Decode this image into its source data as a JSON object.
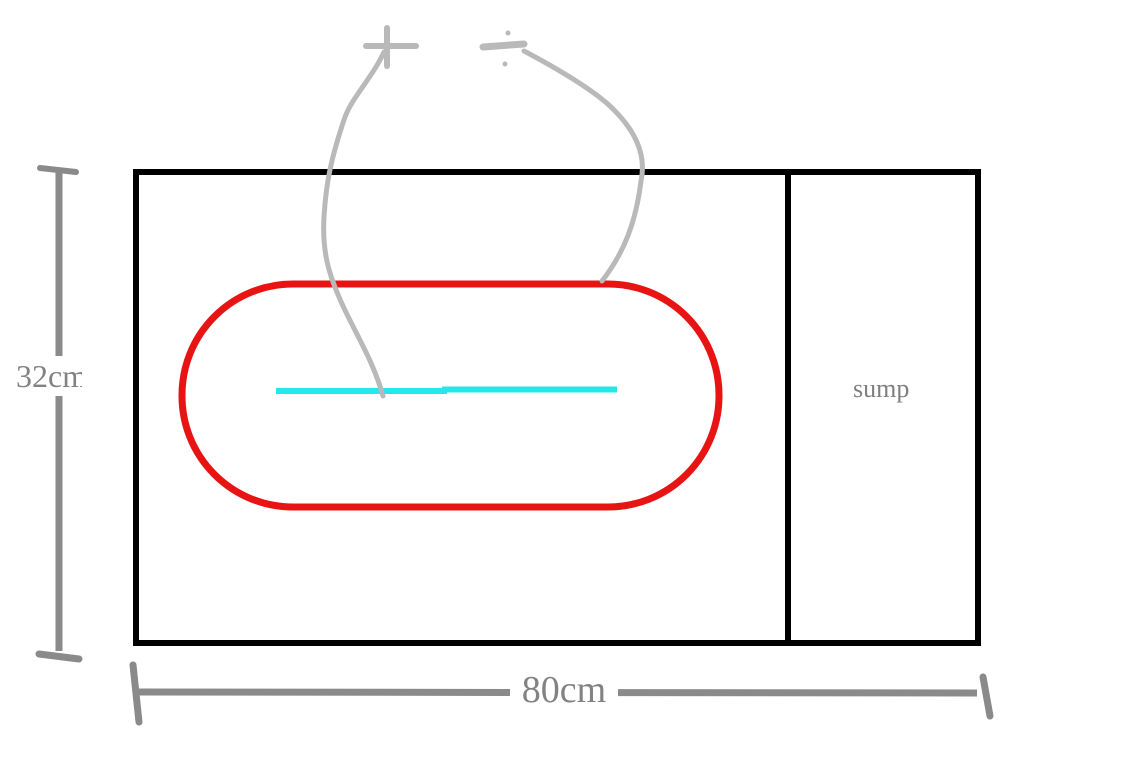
{
  "diagram": {
    "description": "hand-drawn aquarium tank plan with sump compartment, red loop, cyan tube and power wires",
    "labels": {
      "height": "32cm",
      "width": "80cm",
      "compartment": "sump"
    },
    "icons": {
      "positive_terminal": "+",
      "negative_terminal": "-"
    },
    "colors": {
      "outline": "#000000",
      "red_loop": "#e81414",
      "cyan_tube": "#25e6ea",
      "wire": "#b9b9b9",
      "dimension": "#8a8a8a",
      "label_text": "#828282",
      "background": "#ffffff"
    }
  }
}
